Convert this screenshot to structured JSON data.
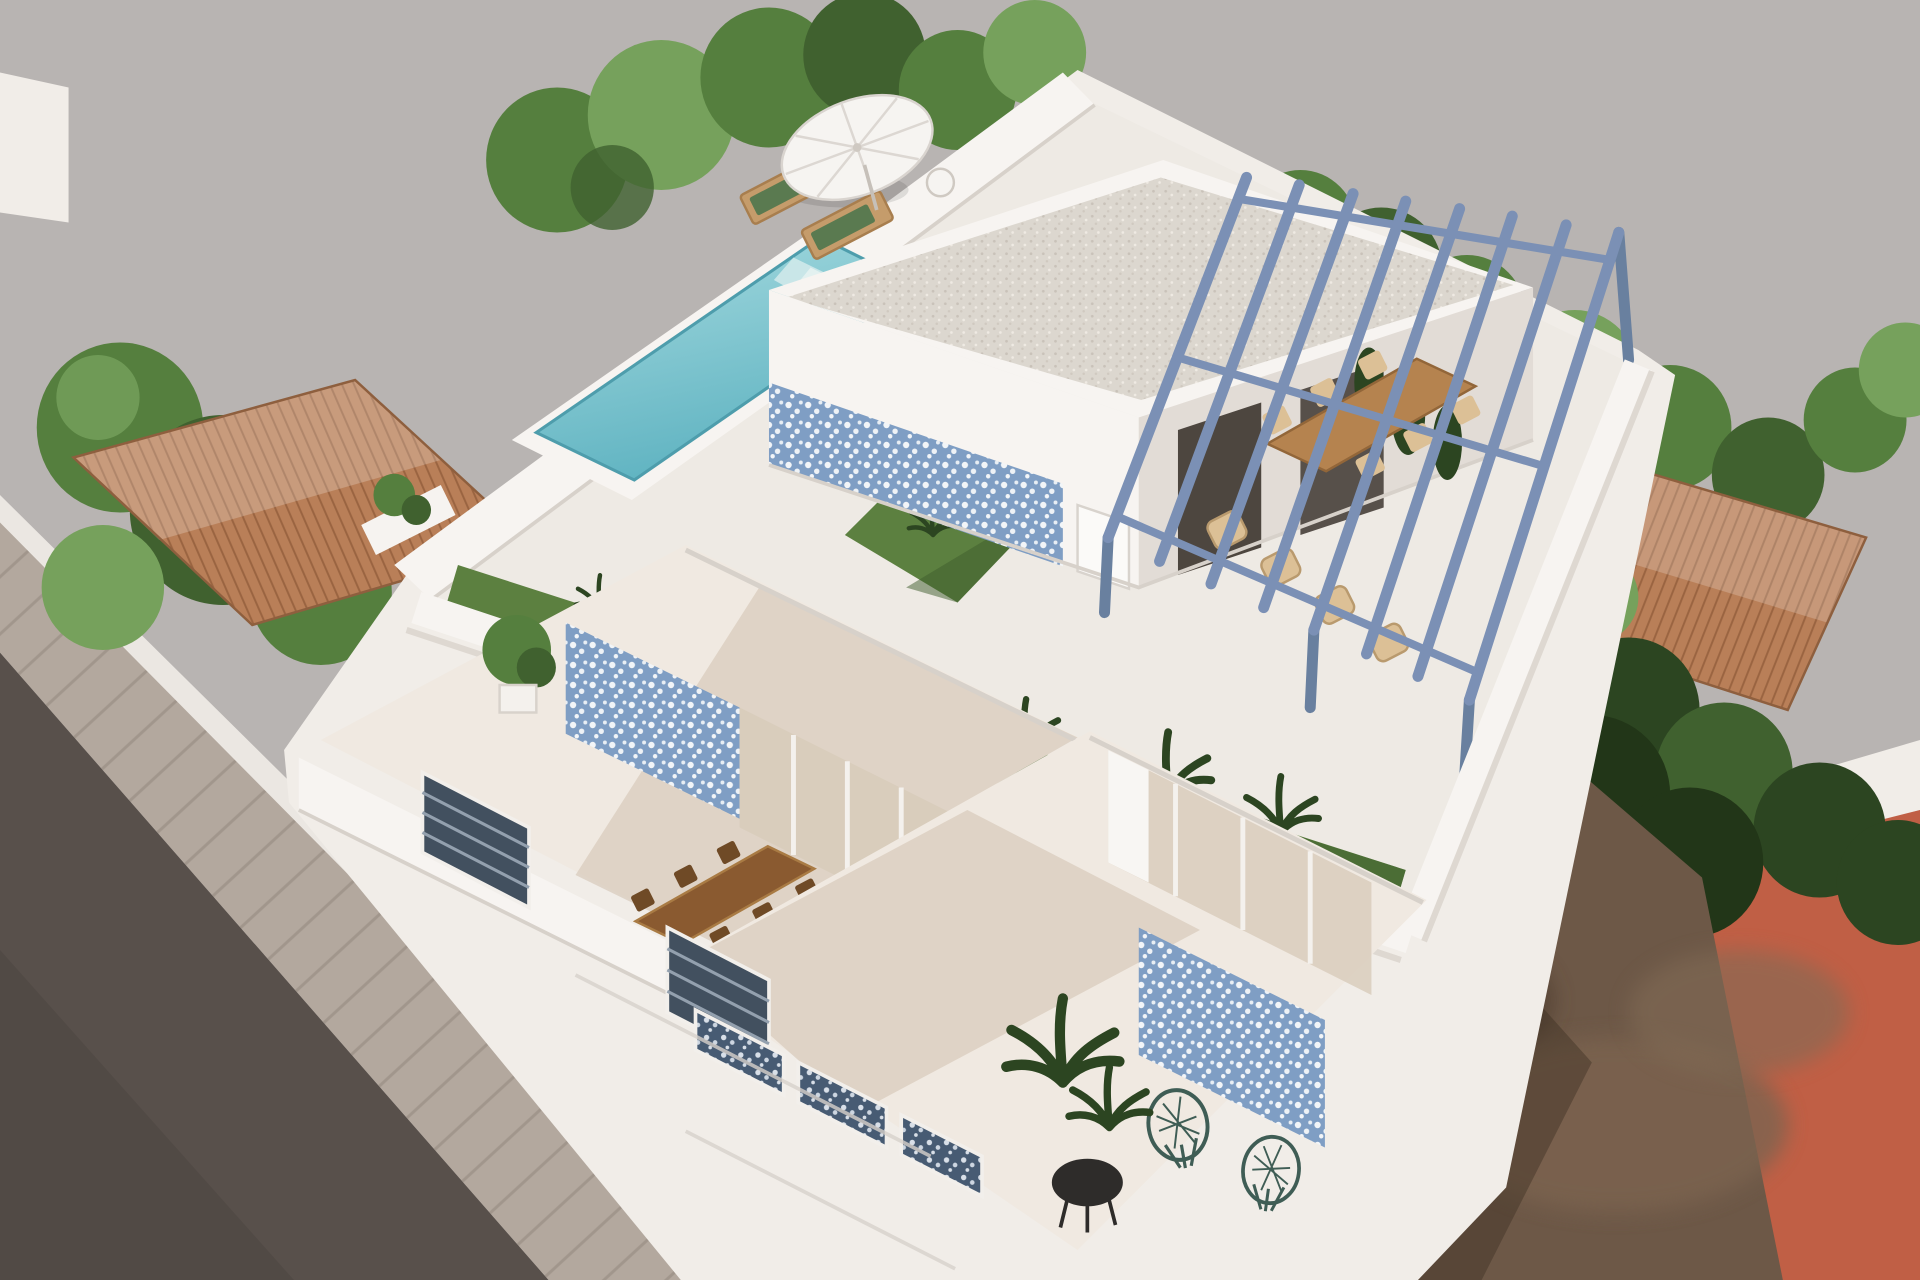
{
  "scene": {
    "type": "architectural-3d-render",
    "view": "aerial-axonometric",
    "description": "Aerial 3D rendering of a modern two-storey white villa with a rooftop terrace holding a lap pool, a sun deck with parasol and loungers, lawn strips with tropical plants, a penthouse volume with a blue patterned tile accent wall, and a steel-blue pergola over an outdoor dining area; stepped lower terraces hold a wood dining set, acapulco wire chairs and a round black table; the plot is framed by a grey street and sidewalk, neighbouring terracotta roofs, green trees, a dark hedge, a vacant brown dirt lot and an orange building corner",
    "elements": [
      {
        "name": "rooftop-pool",
        "label": "Lap pool with white coping and steps"
      },
      {
        "name": "sun-deck",
        "label": "Sun deck with white parasol, two wood loungers with green cushions and a round side table"
      },
      {
        "name": "roof-lawn",
        "label": "Artificial grass strips with tropical plants"
      },
      {
        "name": "penthouse",
        "label": "Rooftop room with gravel flat roof and blue patterned tile accent wall"
      },
      {
        "name": "pergola",
        "label": "Steel-blue pergola grid over rooftop dining area"
      },
      {
        "name": "pergola-dining-set",
        "label": "Wood dining table with six light chairs"
      },
      {
        "name": "rattan-chairs",
        "label": "Row of rattan lounge chairs"
      },
      {
        "name": "first-floor-terrace",
        "label": "First floor terrace with dark wood dining set and tile accent band"
      },
      {
        "name": "ground-terrace",
        "label": "Lower terrace with two acapulco wire chairs, round black table and palm"
      },
      {
        "name": "street-facade",
        "label": "Stepped white parapets with blue tile infill panels and louvered windows"
      },
      {
        "name": "neighbor-roof-left",
        "label": "Terracotta hip roof of left neighbour"
      },
      {
        "name": "neighbor-roof-right",
        "label": "Terracotta roof of right neighbour"
      },
      {
        "name": "street",
        "label": "Asphalt road with paved sidewalk and white curb"
      },
      {
        "name": "street-trees",
        "label": "Green street trees and bushes"
      },
      {
        "name": "hedge",
        "label": "Dark green hedge mass"
      },
      {
        "name": "vacant-lot",
        "label": "Brown dirt vacant lot with building shadow"
      },
      {
        "name": "orange-building",
        "label": "Orange rendered building corner"
      }
    ]
  },
  "palette": {
    "backdrop": "#b8b4b2",
    "road": "#58504b",
    "sidewalk": "#b3a89e",
    "curb": "#ebe7e2",
    "wall_white": "#f1ede8",
    "wall_bright": "#f7f4f1",
    "wall_shade": "#e2dcd6",
    "deck": "#eeeae4",
    "terrace_floor": "#f0e9e1",
    "floor_shadow": "#d8cbbb",
    "gravel": "#dcd7cf",
    "grass": "#5c8040",
    "grass_dark": "#3e5c2c",
    "foliage_light": "#76a15c",
    "foliage_mid": "#557f3e",
    "foliage_dark": "#40612f",
    "hedge": "#2c4521",
    "water_light": "#a7dbe0",
    "water_deep": "#5fb3c1",
    "tile_blue": "#7f9ec4",
    "tile_blue_dark": "#475b73",
    "pergola_blue": "#7b90b5",
    "wood": "#b5834f",
    "wood_dark": "#8a5a30",
    "rattan": "#dcc096",
    "cushion": "#5a7a50",
    "terracotta": "#b97f58",
    "terracotta_dark": "#9a6441",
    "orange_building": "#c05f45",
    "dirt": "#6d5847",
    "dirt_dark": "#514033",
    "glass": "#d9cdbc",
    "slate_window": "#42505f",
    "black": "#2e2c2a"
  }
}
